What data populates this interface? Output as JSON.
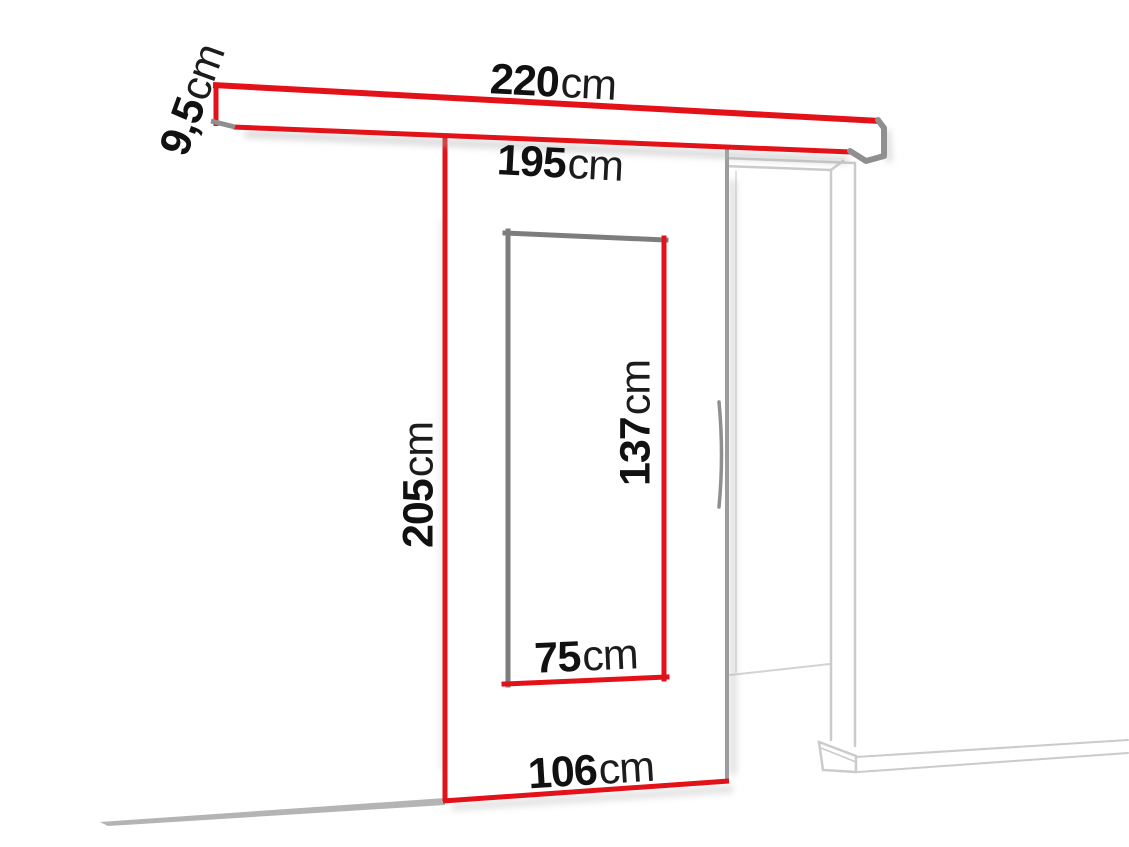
{
  "diagram": {
    "kind": "sliding-door-dimension-diagram",
    "labels": {
      "rail_length": {
        "value": "220",
        "unit": "cm"
      },
      "rail_height": {
        "value": "9,5",
        "unit": "cm"
      },
      "door_opening_width": {
        "value": "195",
        "unit": "cm"
      },
      "door_height": {
        "value": "205",
        "unit": "cm"
      },
      "mirror_height": {
        "value": "137",
        "unit": "cm"
      },
      "mirror_width": {
        "value": "75",
        "unit": "cm"
      },
      "door_width": {
        "value": "106",
        "unit": "cm"
      }
    }
  },
  "colors": {
    "accent_red": "#e21218",
    "frame_gray": "#7d7d7d",
    "rail_cap_gray": "#8f8f8f",
    "door_edge_gray": "#9c9c9c",
    "light_gray": "#cbcbcb",
    "floor_gray": "#b4b4b4",
    "text_color": "#111111"
  }
}
